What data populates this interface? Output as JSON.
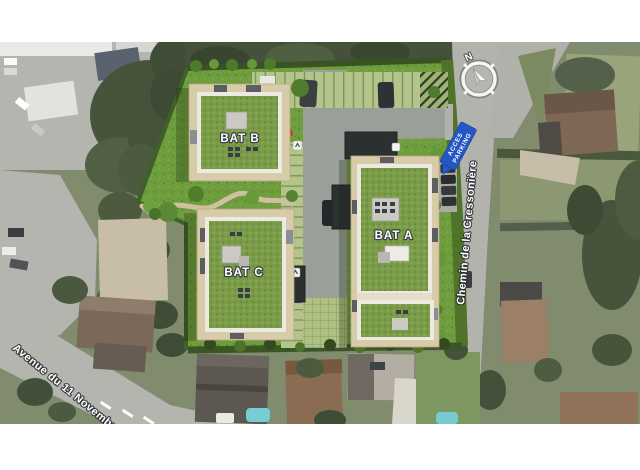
{
  "scene": {
    "type": "aerial-residential-site-plan",
    "compass": {
      "north_label": "N"
    }
  },
  "buildings": [
    {
      "id": "bat-b",
      "label": "BAT B"
    },
    {
      "id": "bat-c",
      "label": "BAT C"
    },
    {
      "id": "bat-a",
      "label": "BAT A"
    }
  ],
  "streets": [
    {
      "id": "avenue-du-11-novembre",
      "name": "Avenue du 11 Novembre"
    },
    {
      "id": "chemin-de-la-cressoniere",
      "name": "Chemin de la Cressonière"
    }
  ],
  "signs": {
    "acces_parking": {
      "line1": "ACCES",
      "line2": "PARKING"
    }
  },
  "colors": {
    "site_lawn": "#6f9e3e",
    "building_roof_green": "#7a9c49",
    "terrace_beige": "#d8cbaa",
    "paver_green": "#b3c58b",
    "hedge_green": "#3a5324",
    "road_gray": "#b2b3ad",
    "sign_blue": "#2456c5",
    "label_white": "#ffffff"
  }
}
